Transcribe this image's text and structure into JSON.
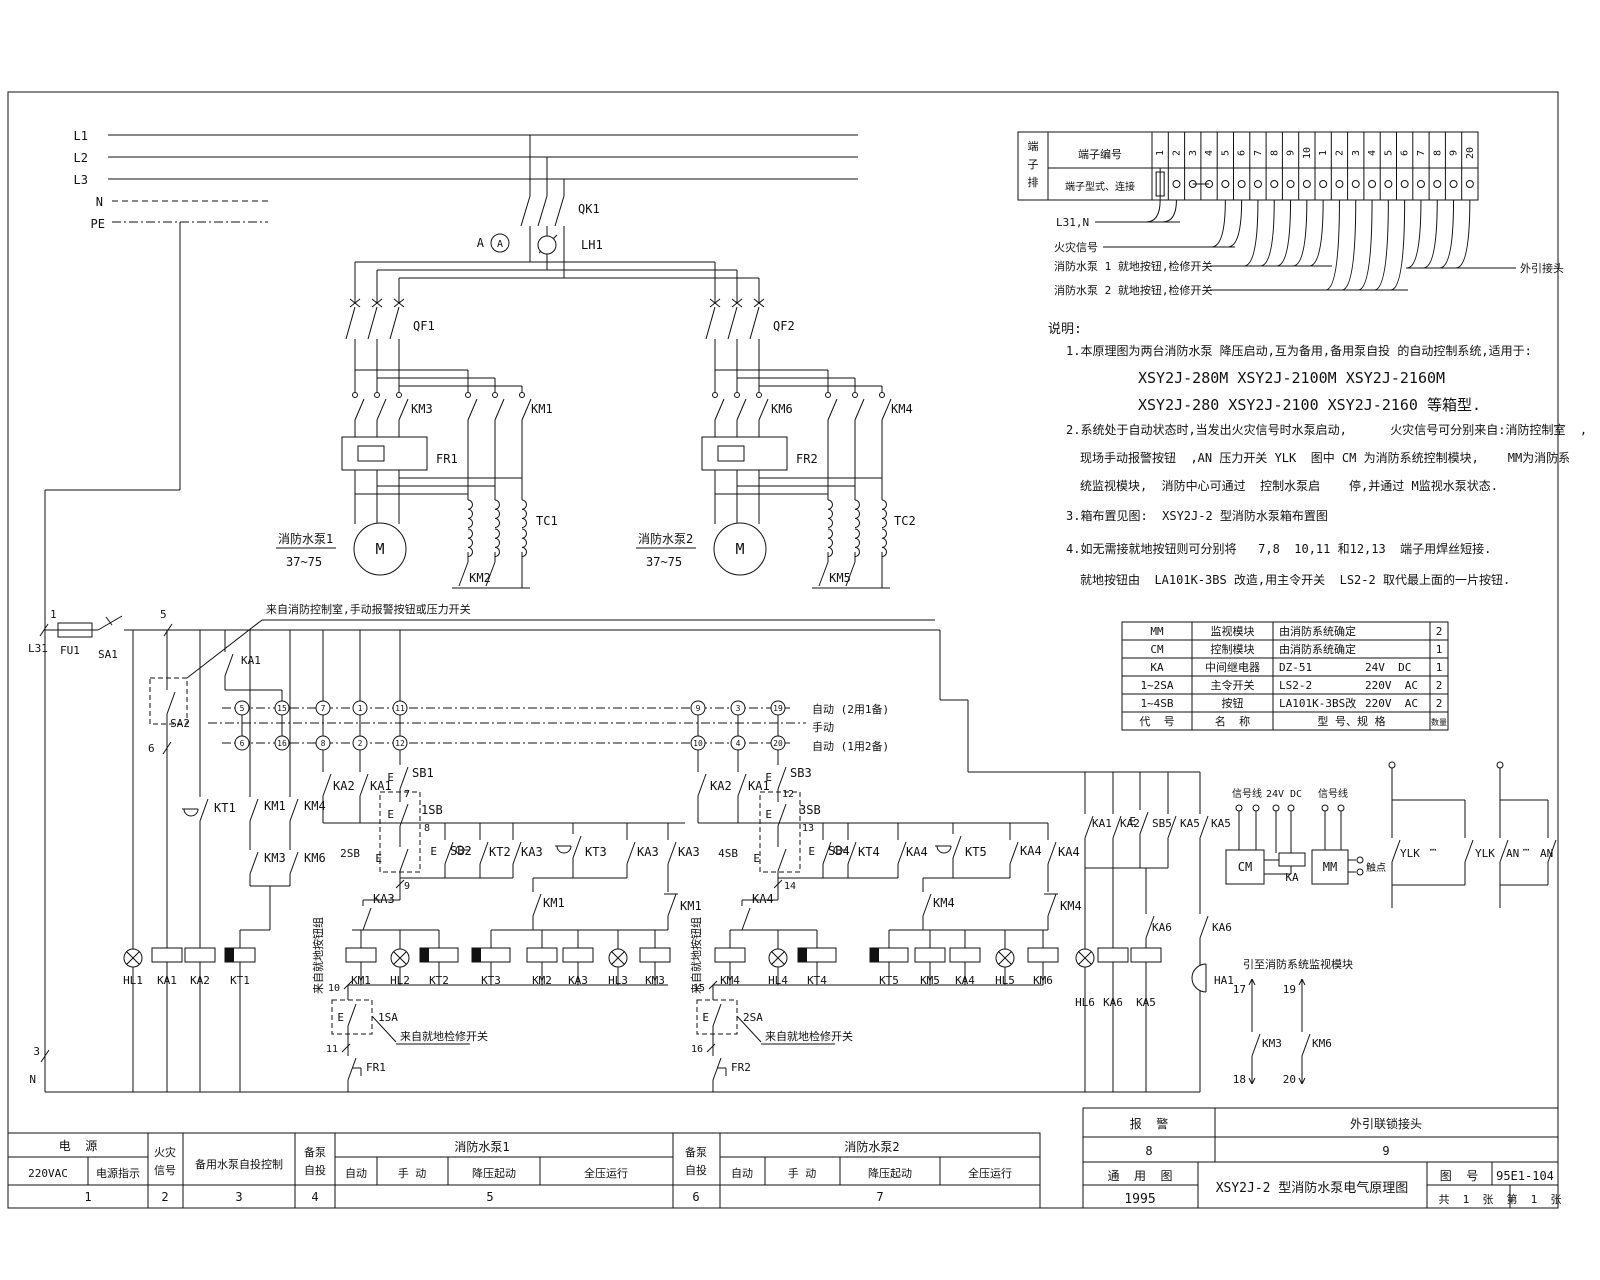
{
  "sheet": {
    "title": "XSY2J-2 型消防水泵电气原理图",
    "drawing_no_label": "图  号",
    "drawing_no": "95E1-104",
    "type_label": "通  用  图",
    "year": "1995",
    "sheets_total": "共  1  张",
    "sheet_no": "第  1  张",
    "alarm_label": "报  警",
    "alarm_no": "8",
    "interlock_label": "外引联锁接头",
    "interlock_no": "9"
  },
  "terminal_table": {
    "corner_chars": [
      "端",
      "子",
      "排"
    ],
    "row1_label": "端子编号",
    "row2_label": "端子型式、连接",
    "numbers": [
      "1",
      "2",
      "3",
      "4",
      "5",
      "6",
      "7",
      "8",
      "9",
      "10",
      "1",
      "2",
      "3",
      "4",
      "5",
      "6",
      "7",
      "8",
      "9",
      "20"
    ],
    "below_labels": [
      "L31,N",
      "火灾信号",
      "消防水泵 1 就地按钮,检修开关",
      "消防水泵 2 就地按钮,检修开关"
    ],
    "right_label": "外引接头"
  },
  "component_table": {
    "rows": [
      [
        "MM",
        "监视模块",
        "由消防系统确定",
        "",
        "2"
      ],
      [
        "CM",
        "控制模块",
        "由消防系统确定",
        "",
        "1"
      ],
      [
        "KA",
        "中间继电器",
        "DZ-51",
        "24V  DC",
        "1"
      ],
      [
        "1~2SA",
        "主令开关",
        "LS2-2",
        "220V  AC",
        "2"
      ],
      [
        "1~4SB",
        "按钮",
        "LA101K-3BS改",
        "220V  AC",
        "2"
      ],
      [
        "代  号",
        "名  称",
        "型 号、规 格",
        "",
        "数量"
      ]
    ]
  },
  "notes": {
    "lines": [
      "说明:",
      "1.本原理图为两台消防水泵 降压启动,互为备用,备用泵自投 的自动控制系统,适用于:",
      "XSY2J-280M XSY2J-2100M XSY2J-2160M",
      "XSY2J-280 XSY2J-2100 XSY2J-2160 等箱型.",
      "2.系统处于自动状态时,当发出火灾信号时水泵启动,      火灾信号可分别来自:消防控制室  ,  KA",
      "现场手动报警按钮  ,AN 压力开关 YLK  图中 CM 为消防系统控制模块,    MM为消防系",
      "统监视模块,  消防中心可通过  控制水泵启    停,并通过 M监视水泵状态.",
      "3.箱布置见图:  XSY2J-2 型消防水泵箱布置图",
      "4.如无需接就地按钮则可分别将   7,8  10,11 和12,13  端子用焊丝短接.",
      "就地按钮由  LA101K-3BS 改造,用主令开关  LS2-2 取代最上面的一片按钮."
    ]
  },
  "bottom_strip": {
    "sections": [
      {
        "header": "电  源",
        "cells": [
          "220VAC",
          "电源指示"
        ],
        "num": "1"
      },
      {
        "header": "火灾信号",
        "num": "2"
      },
      {
        "header": "备用水泵自投控制",
        "num": "3"
      },
      {
        "header": "备泵自投",
        "num": "4"
      },
      {
        "header": "消防水泵1",
        "cells": [
          "自动",
          "手 动",
          "降压起动",
          "全压运行"
        ],
        "num": "5"
      },
      {
        "header": "备泵自投",
        "num": "6"
      },
      {
        "header": "消防水泵2",
        "cells": [
          "自动",
          "手 动",
          "降压起动",
          "全压运行"
        ],
        "num": "7"
      }
    ]
  },
  "labels": [
    [
      "L1",
      88,
      140,
      "e",
      12
    ],
    [
      "L2",
      88,
      162,
      "e",
      12
    ],
    [
      "L3",
      88,
      184,
      "e",
      12
    ],
    [
      "N",
      103,
      206,
      "e",
      12
    ],
    [
      "PE",
      105,
      228,
      "e",
      12
    ],
    [
      "QK1",
      578,
      213,
      "s",
      12
    ],
    [
      "LH1",
      581,
      249,
      "s",
      12
    ],
    [
      "A",
      484,
      247,
      "e",
      12
    ],
    [
      "A",
      500,
      247,
      "m",
      10
    ],
    [
      "QF1",
      413,
      330,
      "s",
      12
    ],
    [
      "KM3",
      411,
      413,
      "s",
      12
    ],
    [
      "KM1",
      531,
      413,
      "s",
      12
    ],
    [
      "FR1",
      436,
      463,
      "s",
      12
    ],
    [
      "TC1",
      536,
      525,
      "s",
      12
    ],
    [
      "KM2",
      480,
      582,
      "m",
      12
    ],
    [
      "消防水泵1",
      278,
      543,
      "s",
      12
    ],
    [
      "37~75",
      286,
      566,
      "s",
      12
    ],
    [
      "M",
      380,
      554,
      "m",
      15
    ],
    [
      "QF2",
      773,
      330,
      "s",
      12
    ],
    [
      "KM6",
      771,
      413,
      "s",
      12
    ],
    [
      "KM4",
      891,
      413,
      "s",
      12
    ],
    [
      "FR2",
      796,
      463,
      "s",
      12
    ],
    [
      "TC2",
      894,
      525,
      "s",
      12
    ],
    [
      "KM5",
      840,
      582,
      "m",
      12
    ],
    [
      "消防水泵2",
      638,
      543,
      "s",
      12
    ],
    [
      "37~75",
      646,
      566,
      "s",
      12
    ],
    [
      "M",
      740,
      554,
      "m",
      15
    ],
    [
      "1",
      50,
      618,
      "s",
      11
    ],
    [
      "L31",
      28,
      652,
      "s",
      11
    ],
    [
      "FU1",
      60,
      654,
      "s",
      11
    ],
    [
      "SA1",
      98,
      658,
      "s",
      11
    ],
    [
      "5",
      160,
      618,
      "s",
      11
    ],
    [
      "6",
      148,
      752,
      "s",
      11
    ],
    [
      "SA2",
      190,
      727,
      "e",
      11
    ],
    [
      "KA1",
      241,
      664,
      "s",
      11
    ],
    [
      "自动 (2用1备)",
      812,
      713,
      "s",
      11
    ],
    [
      "手动",
      812,
      731,
      "s",
      11
    ],
    [
      "自动 (1用2备)",
      812,
      750,
      "s",
      11
    ],
    [
      "KT1",
      214,
      812,
      "s",
      12
    ],
    [
      "KM1",
      264,
      810,
      "s",
      12
    ],
    [
      "KM4",
      304,
      810,
      "s",
      12
    ],
    [
      "KM3",
      264,
      862,
      "s",
      12
    ],
    [
      "KM6",
      304,
      862,
      "s",
      12
    ],
    [
      "HL1",
      133,
      984,
      "m",
      11
    ],
    [
      "KA1",
      167,
      984,
      "m",
      11
    ],
    [
      "KA2",
      200,
      984,
      "m",
      11
    ],
    [
      "KT1",
      240,
      984,
      "m",
      11
    ],
    [
      "5",
      242,
      711,
      "m",
      8
    ],
    [
      "15",
      282,
      711,
      "m",
      8
    ],
    [
      "7",
      323,
      711,
      "m",
      8
    ],
    [
      "1",
      360,
      711,
      "m",
      8
    ],
    [
      "11",
      400,
      711,
      "m",
      8
    ],
    [
      "9",
      698,
      711,
      "m",
      8
    ],
    [
      "3",
      738,
      711,
      "m",
      8
    ],
    [
      "19",
      778,
      711,
      "m",
      8
    ],
    [
      "6",
      242,
      746,
      "m",
      8
    ],
    [
      "16",
      282,
      746,
      "m",
      8
    ],
    [
      "8",
      323,
      746,
      "m",
      8
    ],
    [
      "2",
      360,
      746,
      "m",
      8
    ],
    [
      "12",
      400,
      746,
      "m",
      8
    ],
    [
      "10",
      698,
      746,
      "m",
      8
    ],
    [
      "4",
      738,
      746,
      "m",
      8
    ],
    [
      "20",
      778,
      746,
      "m",
      8
    ],
    [
      "KA2",
      333,
      790,
      "s",
      12
    ],
    [
      "KA1",
      370,
      790,
      "s",
      12
    ],
    [
      "E",
      394,
      781,
      "e",
      11
    ],
    [
      "SB1",
      412,
      777,
      "s",
      12
    ],
    [
      "7",
      404,
      797,
      "s",
      10
    ],
    [
      "E",
      394,
      818,
      "e",
      11
    ],
    [
      "1SB",
      421,
      814,
      "s",
      12
    ],
    [
      "8",
      424,
      831,
      "s",
      10
    ],
    [
      "2SB",
      360,
      857,
      "e",
      11
    ],
    [
      "E",
      382,
      862,
      "e",
      11
    ],
    [
      "E",
      437,
      855,
      "e",
      11
    ],
    [
      "SB2",
      450,
      855,
      "s",
      12
    ],
    [
      "KT2",
      489,
      856,
      "s",
      12
    ],
    [
      "KA3",
      521,
      856,
      "s",
      12
    ],
    [
      "9",
      404,
      889,
      "s",
      10
    ],
    [
      "KA3",
      373,
      903,
      "s",
      12
    ],
    [
      "KT3",
      585,
      856,
      "s",
      12
    ],
    [
      "KA3",
      637,
      856,
      "s",
      12
    ],
    [
      "KA3",
      678,
      856,
      "s",
      12
    ],
    [
      "KM1",
      543,
      907,
      "s",
      12
    ],
    [
      "KM1",
      680,
      910,
      "s",
      12
    ],
    [
      "KM1",
      361,
      984,
      "m",
      11
    ],
    [
      "HL2",
      400,
      984,
      "m",
      11
    ],
    [
      "KT2",
      439,
      984,
      "m",
      11
    ],
    [
      "KT3",
      491,
      984,
      "m",
      11
    ],
    [
      "KM2",
      542,
      984,
      "m",
      11
    ],
    [
      "KA3",
      578,
      984,
      "m",
      11
    ],
    [
      "HL3",
      618,
      984,
      "m",
      11
    ],
    [
      "KM3",
      655,
      984,
      "m",
      11
    ],
    [
      "10",
      340,
      991,
      "e",
      10
    ],
    [
      "E",
      344,
      1021,
      "e",
      11
    ],
    [
      "1SA",
      378,
      1021,
      "s",
      11
    ],
    [
      "来自就地检修开关",
      400,
      1040,
      "s",
      11
    ],
    [
      "11",
      338,
      1052,
      "e",
      10
    ],
    [
      "FR1",
      366,
      1071,
      "s",
      11
    ],
    [
      "来自就地按钮组",
      322,
      994,
      "s",
      11,
      -90
    ],
    [
      "KA2",
      710,
      790,
      "s",
      12
    ],
    [
      "KA1",
      748,
      790,
      "s",
      12
    ],
    [
      "E",
      772,
      781,
      "e",
      11
    ],
    [
      "SB3",
      790,
      777,
      "s",
      12
    ],
    [
      "12",
      782,
      797,
      "s",
      10
    ],
    [
      "E",
      772,
      818,
      "e",
      11
    ],
    [
      "3SB",
      799,
      814,
      "s",
      12
    ],
    [
      "13",
      802,
      831,
      "s",
      10
    ],
    [
      "4SB",
      738,
      857,
      "e",
      11
    ],
    [
      "E",
      760,
      862,
      "e",
      11
    ],
    [
      "E",
      815,
      855,
      "e",
      11
    ],
    [
      "SB4",
      828,
      855,
      "s",
      12
    ],
    [
      "KT4",
      858,
      856,
      "s",
      12
    ],
    [
      "KA4",
      906,
      856,
      "s",
      12
    ],
    [
      "14",
      784,
      889,
      "s",
      10
    ],
    [
      "KA4",
      752,
      903,
      "s",
      12
    ],
    [
      "KT5",
      965,
      856,
      "s",
      12
    ],
    [
      "KA4",
      1020,
      855,
      "s",
      12
    ],
    [
      "KA4",
      1058,
      856,
      "s",
      12
    ],
    [
      "KM4",
      933,
      907,
      "s",
      12
    ],
    [
      "KM4",
      1060,
      910,
      "s",
      12
    ],
    [
      "KM4",
      730,
      984,
      "m",
      11
    ],
    [
      "HL4",
      778,
      984,
      "m",
      11
    ],
    [
      "KT4",
      817,
      984,
      "m",
      11
    ],
    [
      "KT5",
      889,
      984,
      "m",
      11
    ],
    [
      "KM5",
      930,
      984,
      "m",
      11
    ],
    [
      "KA4",
      965,
      984,
      "m",
      11
    ],
    [
      "HL5",
      1005,
      984,
      "m",
      11
    ],
    [
      "KM6",
      1043,
      984,
      "m",
      11
    ],
    [
      "15",
      705,
      991,
      "e",
      10
    ],
    [
      "E",
      709,
      1021,
      "e",
      11
    ],
    [
      "2SA",
      743,
      1021,
      "s",
      11
    ],
    [
      "来自就地检修开关",
      765,
      1040,
      "s",
      11
    ],
    [
      "16",
      703,
      1052,
      "e",
      10
    ],
    [
      "FR2",
      731,
      1071,
      "s",
      11
    ],
    [
      "来自就地按钮组",
      700,
      994,
      "s",
      11,
      -90
    ],
    [
      "KA1",
      1092,
      827,
      "s",
      11
    ],
    [
      "KA2",
      1120,
      827,
      "s",
      11
    ],
    [
      "E",
      1136,
      825,
      "e",
      11
    ],
    [
      "SB5",
      1152,
      827,
      "s",
      11
    ],
    [
      "KA5",
      1180,
      827,
      "s",
      11
    ],
    [
      "KA5",
      1211,
      827,
      "s",
      11
    ],
    [
      "KA6",
      1152,
      931,
      "s",
      11
    ],
    [
      "KA6",
      1212,
      931,
      "s",
      11
    ],
    [
      "HL6",
      1085,
      1006,
      "m",
      11
    ],
    [
      "KA6",
      1113,
      1006,
      "m",
      11
    ],
    [
      "KA5",
      1146,
      1006,
      "m",
      11
    ],
    [
      "HA1",
      1214,
      984,
      "s",
      11
    ],
    [
      "信号线",
      1247,
      797,
      "m",
      10
    ],
    [
      "24V DC",
      1284,
      797,
      "m",
      10
    ],
    [
      "信号线",
      1333,
      797,
      "m",
      10
    ],
    [
      "CM",
      1245,
      871,
      "m",
      12
    ],
    [
      "KA",
      1292,
      881,
      "m",
      11
    ],
    [
      "MM",
      1330,
      871,
      "m",
      12
    ],
    [
      "触点",
      1366,
      871,
      "s",
      10
    ],
    [
      "YLK",
      1400,
      857,
      "s",
      11
    ],
    [
      "⋯",
      1433,
      853,
      "m",
      11
    ],
    [
      "YLK",
      1475,
      857,
      "s",
      11
    ],
    [
      "AN",
      1506,
      857,
      "s",
      11
    ],
    [
      "⋯",
      1526,
      853,
      "m",
      11
    ],
    [
      "AN",
      1540,
      857,
      "s",
      11
    ],
    [
      "引至消防系统监视模块",
      1243,
      968,
      "s",
      11
    ],
    [
      "17",
      1246,
      993,
      "e",
      11
    ],
    [
      "19",
      1296,
      993,
      "e",
      11
    ],
    [
      "KM3",
      1262,
      1047,
      "s",
      11
    ],
    [
      "KM6",
      1312,
      1047,
      "s",
      11
    ],
    [
      "18",
      1246,
      1083,
      "e",
      11
    ],
    [
      "20",
      1296,
      1083,
      "e",
      11
    ],
    [
      "3",
      40,
      1055,
      "e",
      11
    ],
    [
      "N",
      36,
      1083,
      "e",
      11
    ],
    [
      "来自消防控制室,手动报警按钮或压力开关",
      266,
      613,
      "s",
      11
    ],
    [
      "端",
      1033,
      150,
      "m",
      11
    ],
    [
      "子",
      1033,
      168,
      "m",
      11
    ],
    [
      "排",
      1033,
      186,
      "m",
      11
    ],
    [
      "端子编号",
      1100,
      158,
      "m",
      11
    ],
    [
      "端子型式、连接",
      1100,
      190,
      "m",
      10
    ]
  ],
  "colors": {
    "line": "#111111",
    "bg": "#ffffff"
  }
}
